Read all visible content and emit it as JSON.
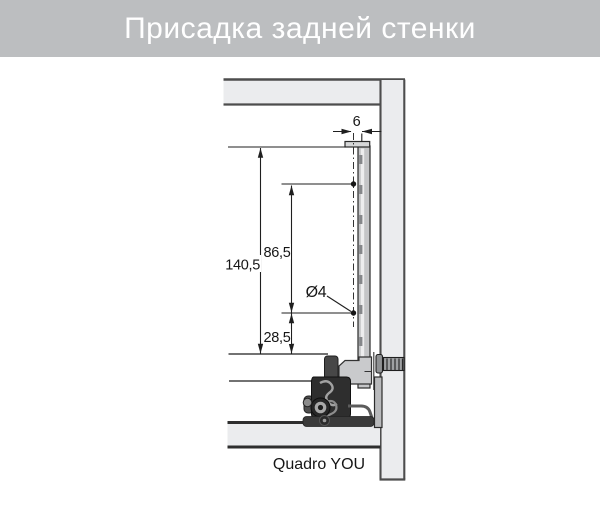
{
  "header": {
    "title": "Присадка задней стенки",
    "bg_color": "#bcbec0",
    "text_color": "#ffffff"
  },
  "drawing": {
    "caption": "Quadro YOU",
    "dimensions": {
      "rear_offset": "6",
      "back_wall_height": "140,5",
      "hole_spacing": "86,5",
      "bottom_hole_offset": "28,5",
      "hole_diameter": "Ø4"
    },
    "colors": {
      "panel_fill": "#ebecee",
      "line": "#1f1f1f",
      "mechanism_dark": "#2e2e2e",
      "mechanism_light": "#c9cacc"
    }
  }
}
